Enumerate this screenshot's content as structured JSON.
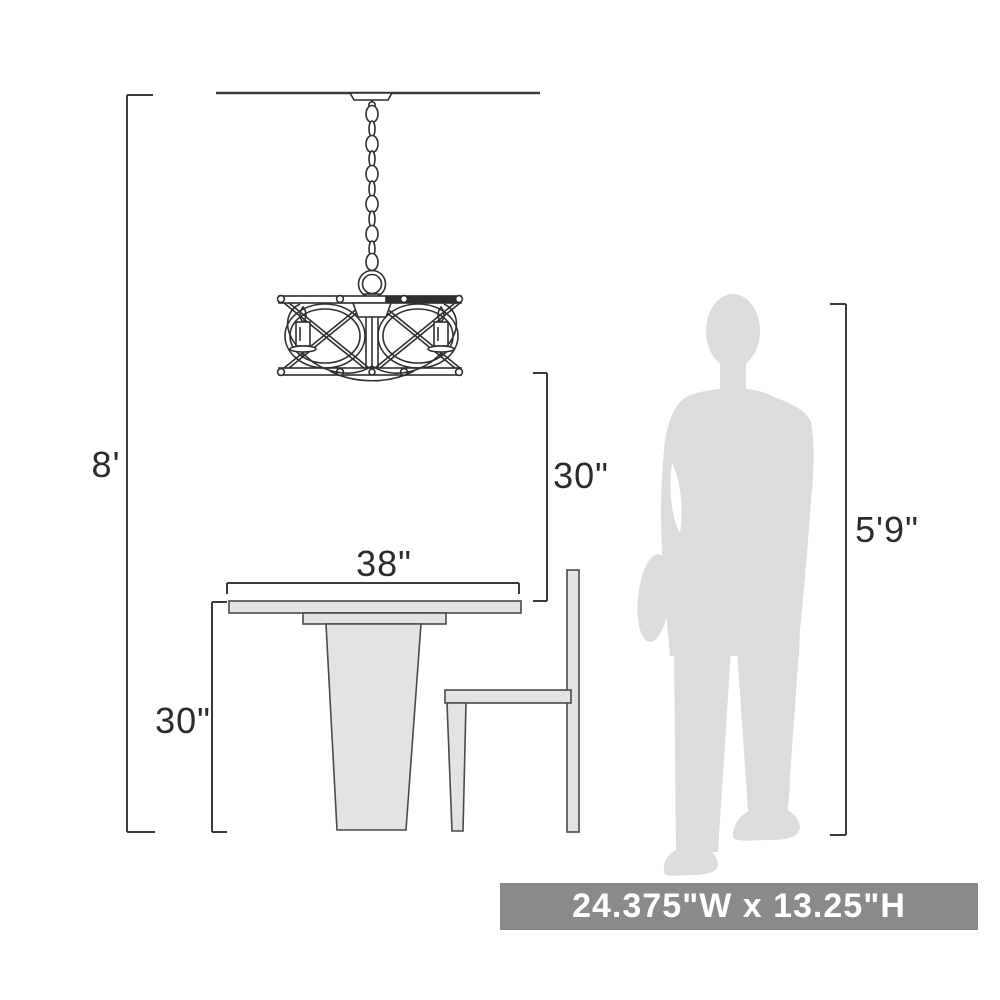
{
  "diagram": {
    "dimensions": {
      "ceiling_height": "8'",
      "fixture_bottom_to_table": "30\"",
      "table_width": "38\"",
      "table_height": "30\"",
      "person_height": "5'9\""
    },
    "size_banner": "24.375\"W x 13.25\"H",
    "colors": {
      "line": "#3a3a3a",
      "fixture_line": "#2f2f2f",
      "furniture_fill": "#e3e3e3",
      "furniture_stroke": "#4a4a4a",
      "silhouette_fill": "#dcdcdc",
      "banner_background": "#8a8a8a",
      "banner_text": "#ffffff"
    }
  }
}
